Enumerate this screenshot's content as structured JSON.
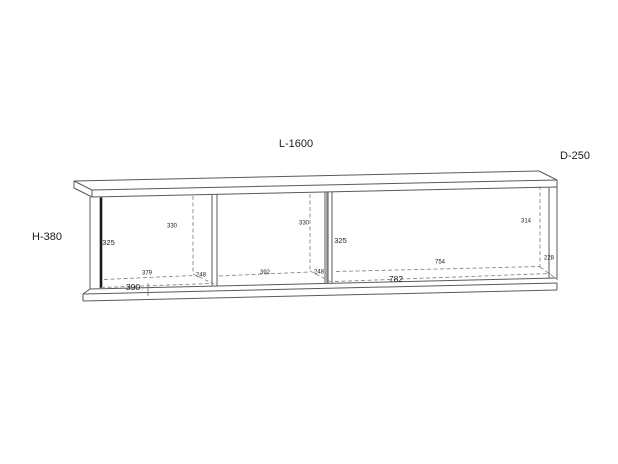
{
  "drawing": {
    "title": "wall-shelf technical drawing",
    "overall": {
      "length": "L-1600",
      "depth": "D-250",
      "height": "H-380"
    },
    "labels": {
      "front_height_left": "325",
      "front_height_right": "325",
      "back_height_left": "330",
      "back_height_mid": "330",
      "back_height_right": "314",
      "back_width_left": "379",
      "back_width_mid": "392",
      "back_width_right": "754",
      "front_width_left": "390",
      "front_width_right": "782",
      "depth_left": "248",
      "depth_mid": "248",
      "depth_right": "228"
    },
    "colors": {
      "background": "#ffffff",
      "line": "#5a5a5a",
      "bold_edge": "#1a1a1a",
      "hidden_edge": "#8a8a8a",
      "text": "#1c1c1c"
    }
  }
}
